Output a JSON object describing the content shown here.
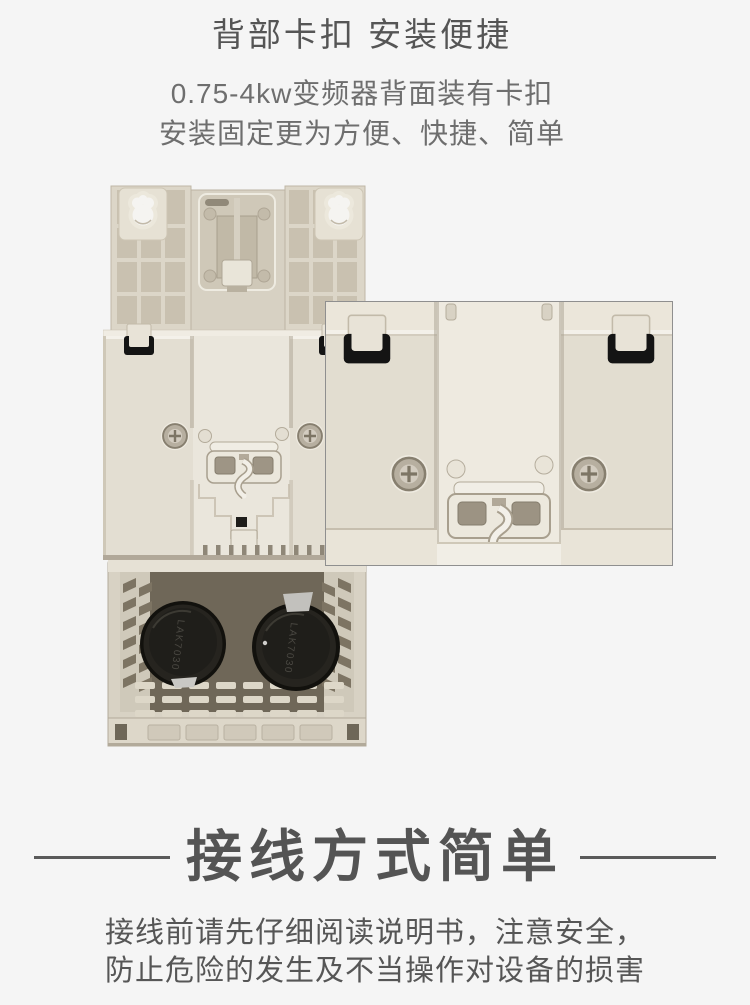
{
  "feature": {
    "title": "背部卡扣 安装便捷",
    "subtitle_line1": "0.75-4kw变频器背面装有卡扣",
    "subtitle_line2": "安装固定更为方便、快捷、简单"
  },
  "photo": {
    "capacitor_marking": "LAK7030"
  },
  "wiring": {
    "title": "接线方式简单",
    "caution_line1": "接线前请先仔细阅读说明书，注意安全，",
    "caution_line2": "防止危险的发生及不当操作对设备的损害"
  },
  "colors": {
    "page_background": "#f5f5f5",
    "heading_text": "#555555",
    "subtitle_text": "#6e6e6e",
    "wiring_title_text": "#545454",
    "caution_text": "#565656",
    "rule_line": "#5a5a5a",
    "device_body_beige": "#e2dcd0",
    "device_recess": "#c9c1b0",
    "clip_black": "#141414",
    "capacitor_black": "#1f1e1a",
    "cage_interior": "#6f6758",
    "inset_border": "#8f8f8f"
  }
}
